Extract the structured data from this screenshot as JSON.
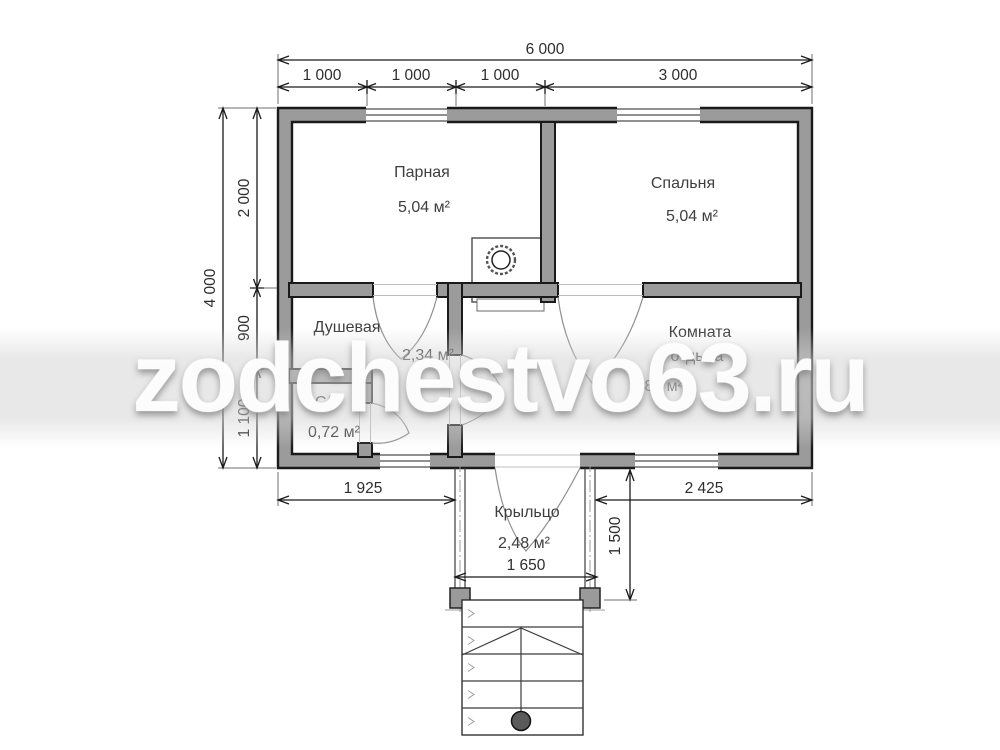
{
  "watermark": {
    "text": "zodchestvo63.ru"
  },
  "rooms": {
    "parnaya": {
      "name": "Парная",
      "area": "5,04 м²"
    },
    "spalnya": {
      "name": "Спальня",
      "area": "5,04 м²"
    },
    "dushevaya": {
      "name": "Душевая",
      "area": "2,34 м²"
    },
    "komnata": {
      "name_line1": "Комната",
      "name_line2": "отдыха",
      "area": "6,84 м²"
    },
    "su": {
      "name": "С/У",
      "area": "0,72 м²"
    },
    "kryltso": {
      "name": "Крыльцо",
      "area": "2,48 м²"
    }
  },
  "dimensions": {
    "total_width": "6 000",
    "top_segments": [
      "1 000",
      "1 000",
      "1 000",
      "3 000"
    ],
    "total_height": "4 000",
    "left_segments": [
      "2 000",
      "900",
      "1 100"
    ],
    "bottom_left": "1 925",
    "bottom_right": "2 425",
    "porch_width": "1 650",
    "porch_depth": "1 500"
  },
  "colors": {
    "wall_fill": "#9b9b9b",
    "line": "#1a1a1a",
    "watermark": "rgba(253,253,253,0.92)"
  }
}
